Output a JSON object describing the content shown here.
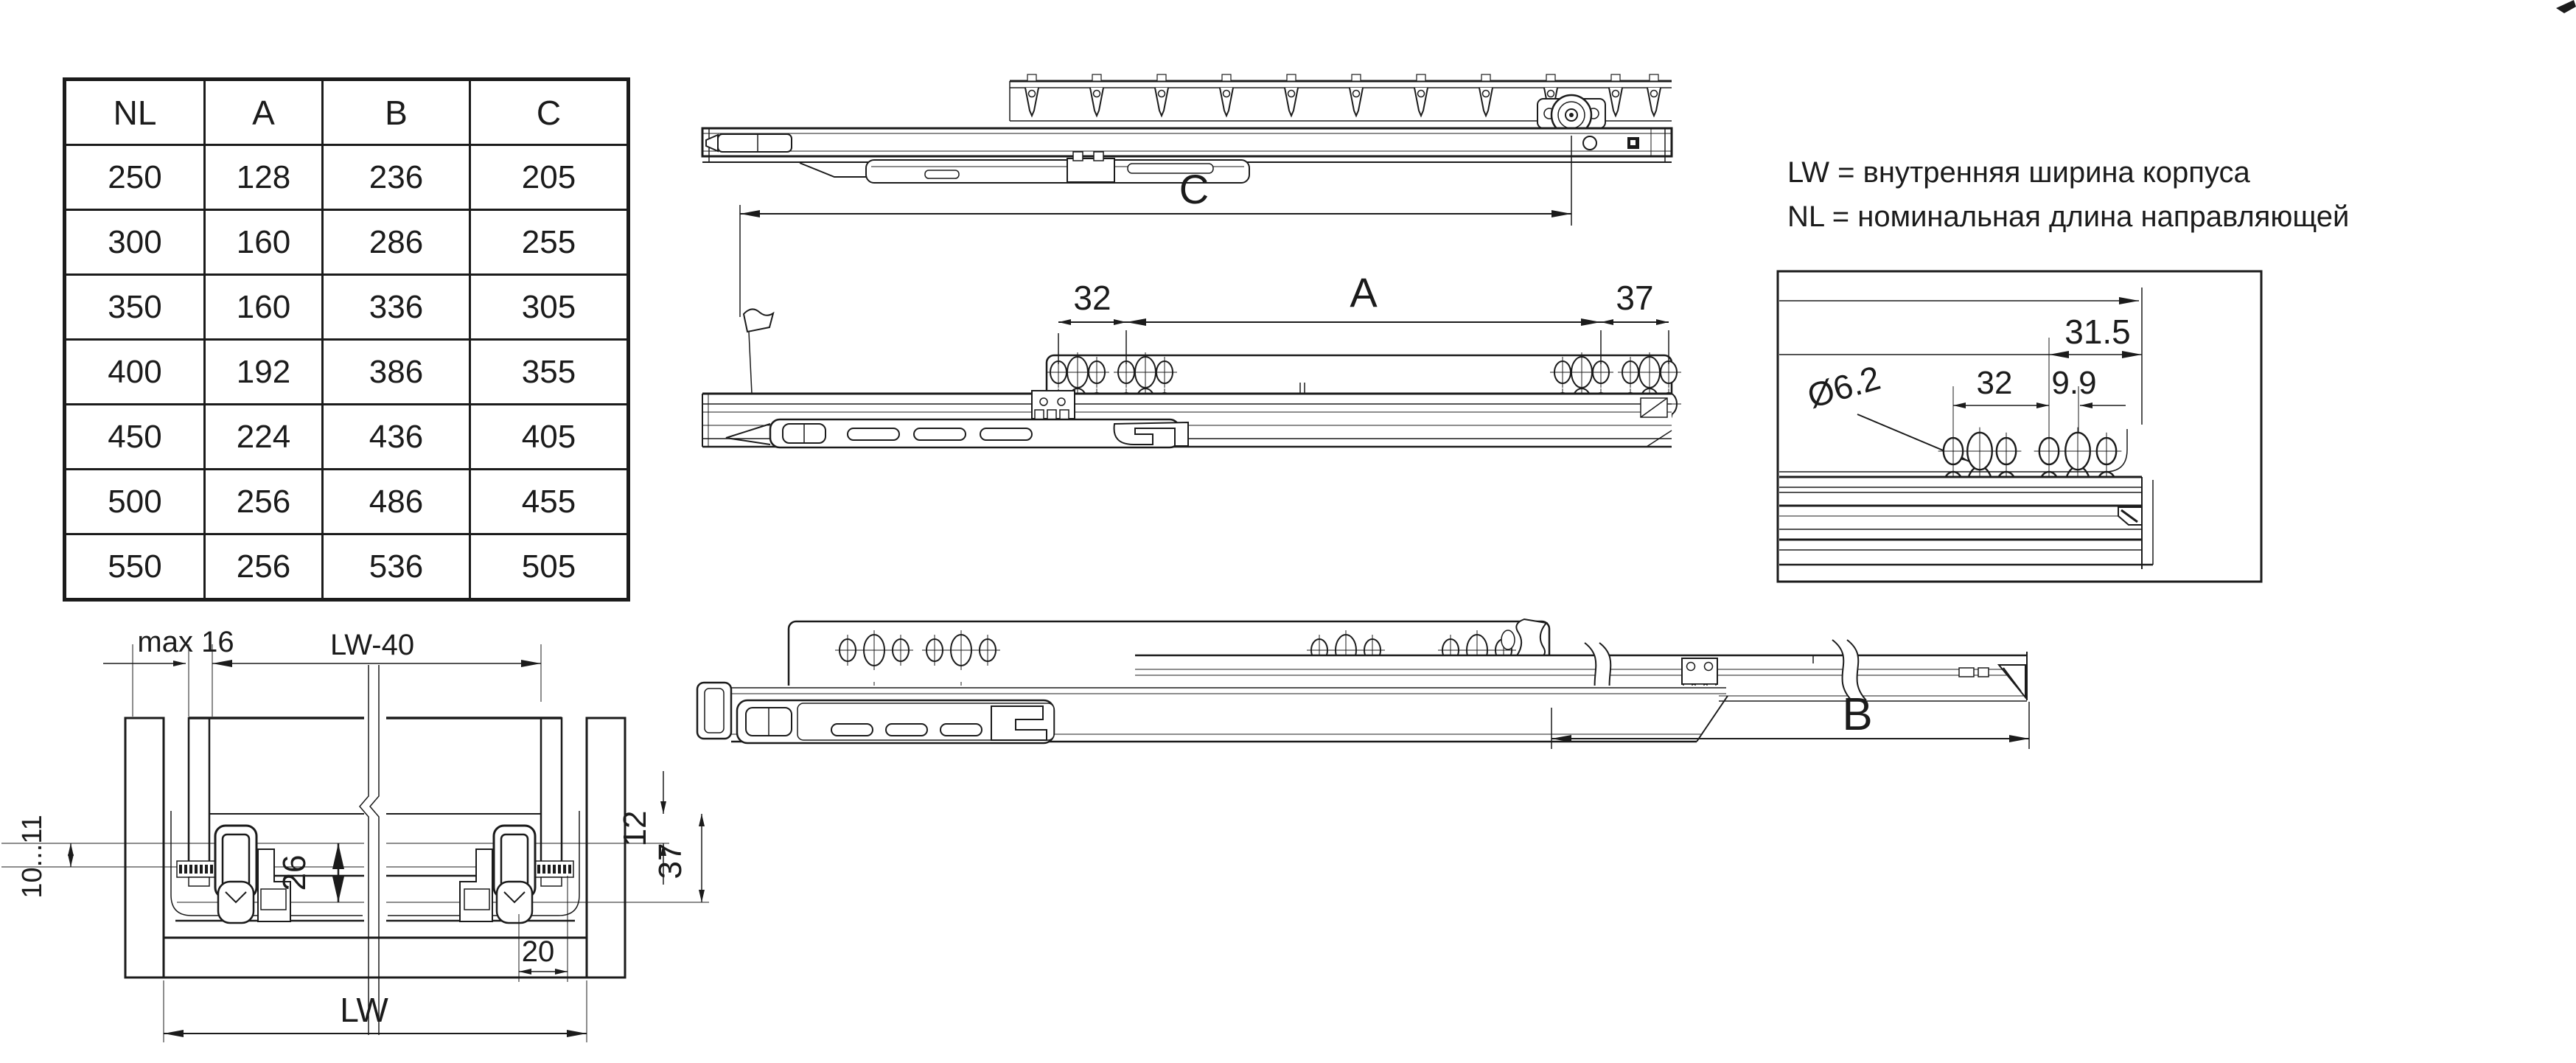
{
  "table": {
    "headers": [
      "NL",
      "A",
      "B",
      "C"
    ],
    "rows": [
      [
        250,
        128,
        236,
        205
      ],
      [
        300,
        160,
        286,
        255
      ],
      [
        350,
        160,
        336,
        305
      ],
      [
        400,
        192,
        386,
        355
      ],
      [
        450,
        224,
        436,
        405
      ],
      [
        500,
        256,
        486,
        455
      ],
      [
        550,
        256,
        536,
        505
      ]
    ]
  },
  "notes": {
    "lw": "LW = внутренняя ширина корпуса",
    "nl": "NL = номинальная длина направляющей"
  },
  "labels": {
    "dim_c": "C",
    "dim_a": "A",
    "dim_b": "B",
    "mid_32": "32",
    "mid_37": "37",
    "det_31_5": "31.5",
    "det_32": "32",
    "det_9_9": "9.9",
    "det_dia": "Ø6.2",
    "cs_max16": "max 16",
    "cs_lw40": "LW-40",
    "cs_10_11": "10...11",
    "cs_26": "26",
    "cs_12": "12",
    "cs_37": "37",
    "cs_20": "20",
    "cs_lw": "LW"
  },
  "colors": {
    "ink": "#1b1b1b",
    "background": "#ffffff"
  }
}
